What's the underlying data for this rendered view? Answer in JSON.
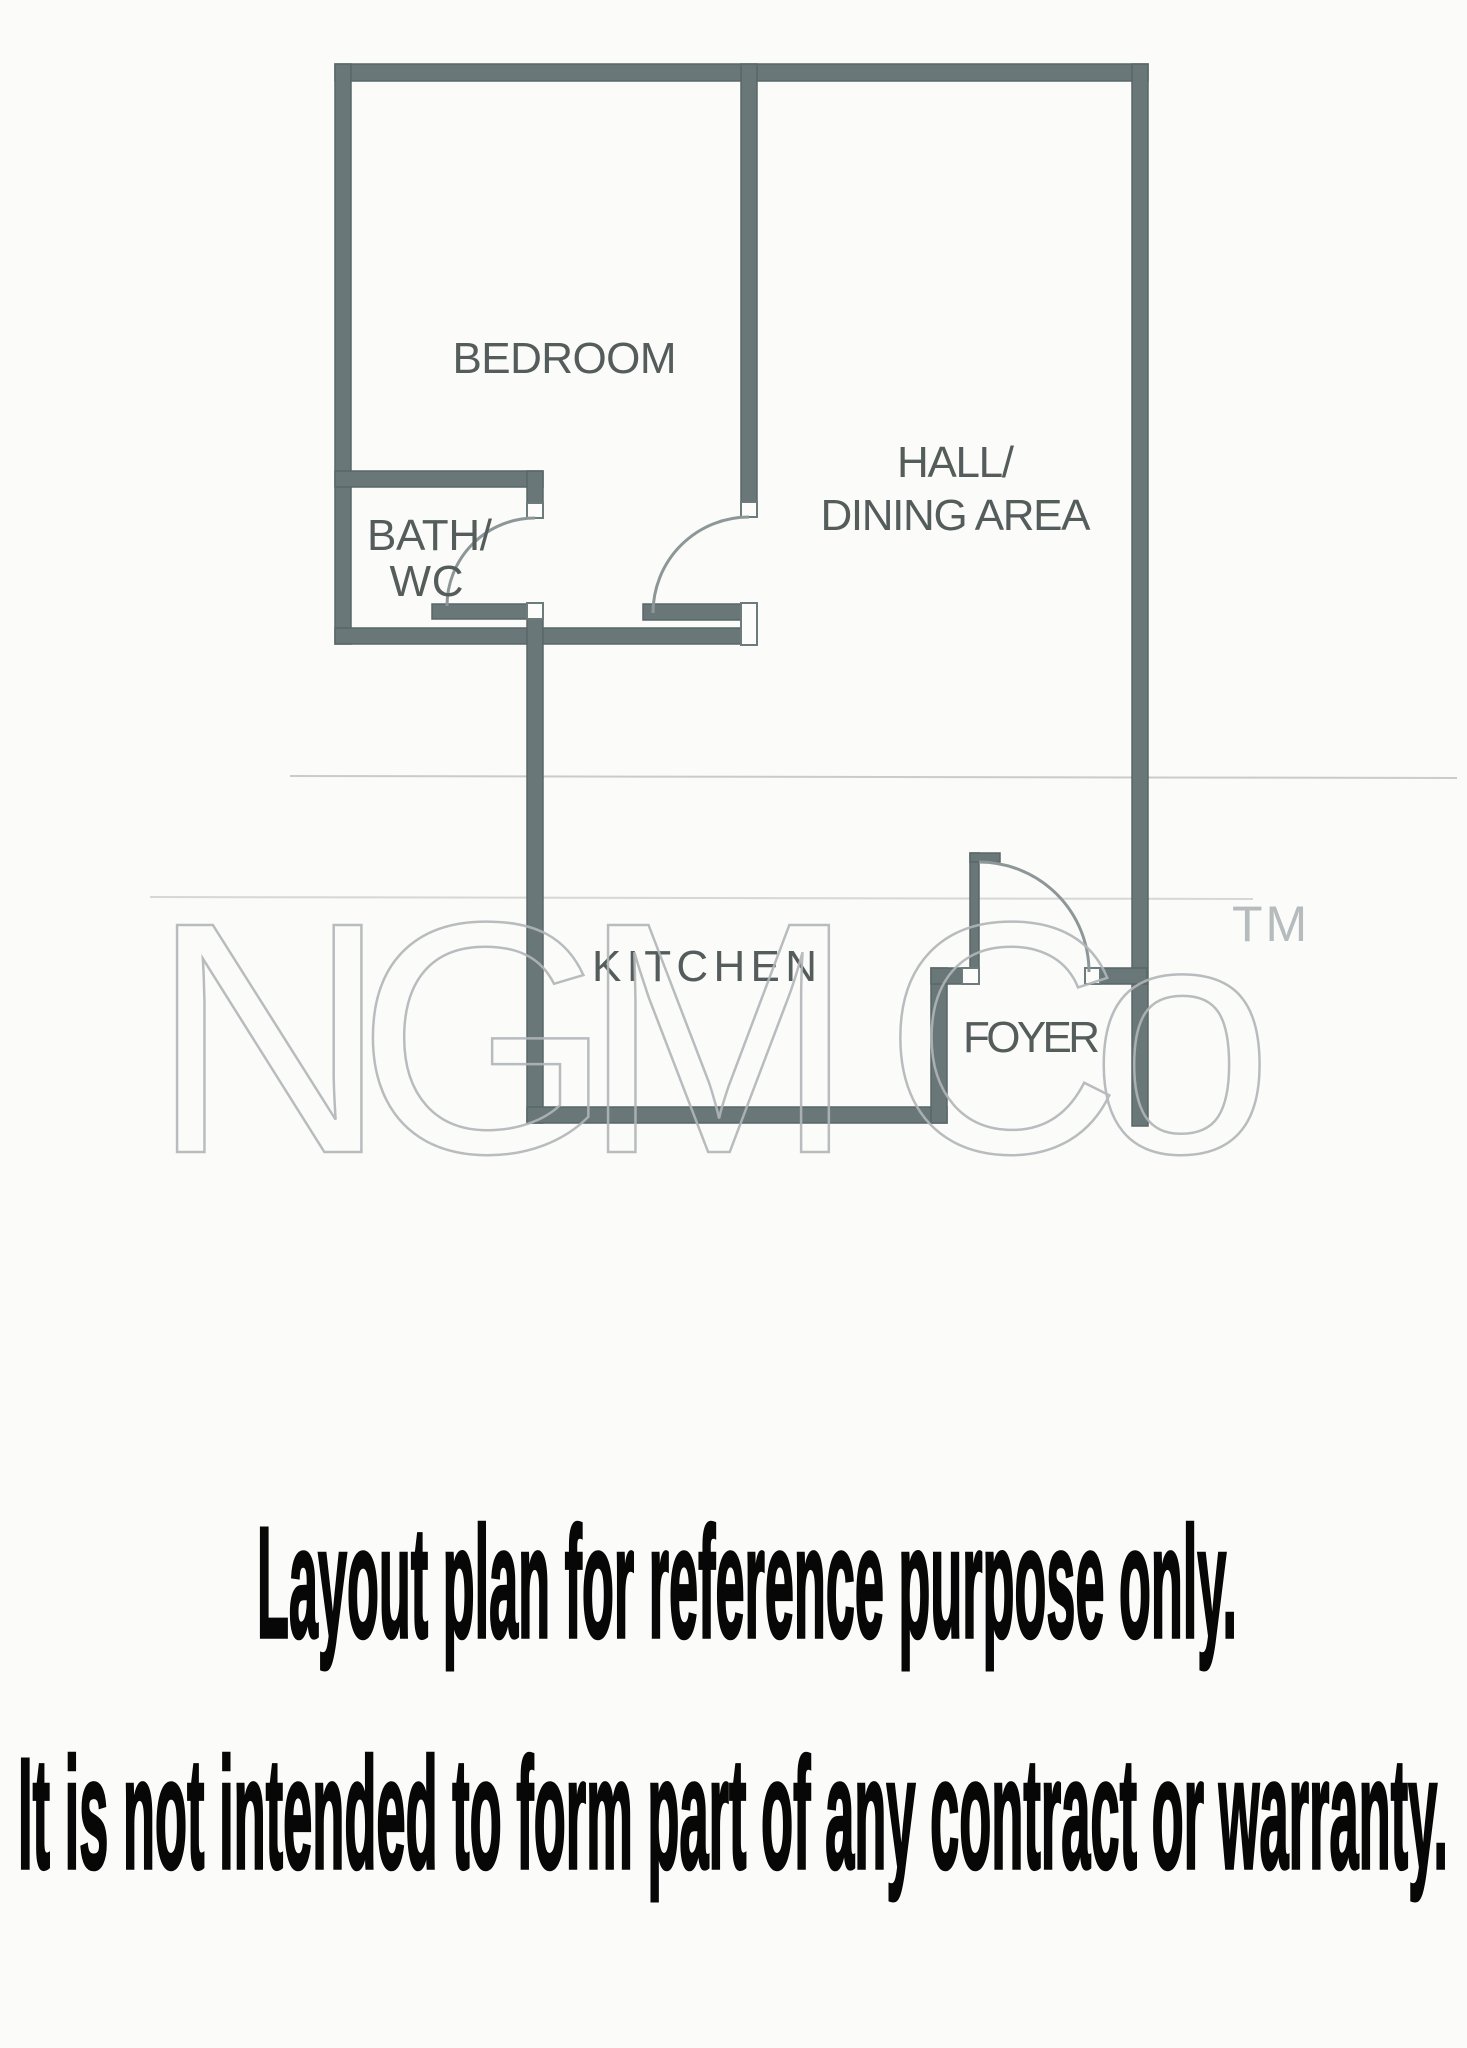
{
  "page": {
    "background_color": "#fbfbf9",
    "type": "scanned floor plan page"
  },
  "floor_plan": {
    "wall_color": "#6a7778",
    "wall_outline_color": "#596767",
    "door_arc_color": "#8d9798",
    "label_color": "#555d5c",
    "rooms": {
      "bedroom": "BEDROOM",
      "hall_line1": "HALL/",
      "hall_line2": "DINING AREA",
      "bath_line1": "BATH/",
      "bath_line2": "WC",
      "kitchen": "KITCHEN",
      "foyer": "FOYER"
    }
  },
  "watermark": {
    "text": "NGM Co",
    "tm": "TM",
    "color": "#b1b6b8"
  },
  "disclaimer": {
    "line1": "Layout plan for reference purpose only.",
    "line2": "It is not intended to form part of any contract or warranty.",
    "color": "#070707"
  }
}
